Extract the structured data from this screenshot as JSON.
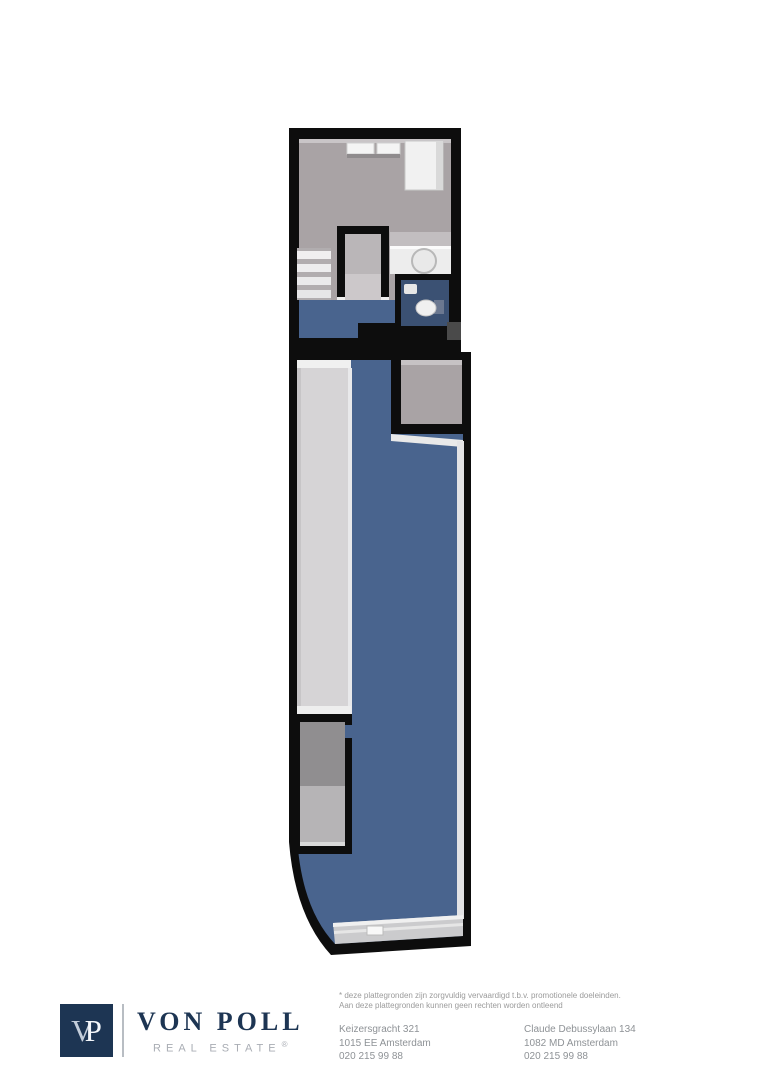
{
  "colors": {
    "wall": "#0d0d0d",
    "floorBlue": "#49648e",
    "floorBlueDark": "#3b5173",
    "floorGray": "#a9a3a5",
    "floorLight": "#d6d4d6",
    "brandNavy": "#1d3553",
    "brandGray": "#a9adb4",
    "textGray": "#8e9296",
    "background": "#ffffff"
  },
  "floorplan": {
    "description": "3D top-down floor plan of a narrow property: upper room with cabinets, counter with round sink, stairs, stair enclosure, blue hallway, toilet room; long lower room with blue floor, light side strip, alcove, closet and curved entrance front"
  },
  "footer": {
    "logo": {
      "monogram_v": "V",
      "monogram_p": "P",
      "brand": "VON POLL",
      "tagline": "REAL ESTATE",
      "registered": "®"
    },
    "disclaimer_line1": "* deze plattegronden zijn zorgvuldig vervaardigd t.b.v. promotionele doeleinden.",
    "disclaimer_line2": "Aan deze plattegronden kunnen geen rechten worden ontleend",
    "offices": [
      {
        "address": "Keizersgracht 321",
        "city": "1015 EE Amsterdam",
        "phone": "020 215 99 88"
      },
      {
        "address": "Claude Debussylaan 134",
        "city": "1082 MD Amsterdam",
        "phone": "020 215 99 88"
      }
    ]
  }
}
